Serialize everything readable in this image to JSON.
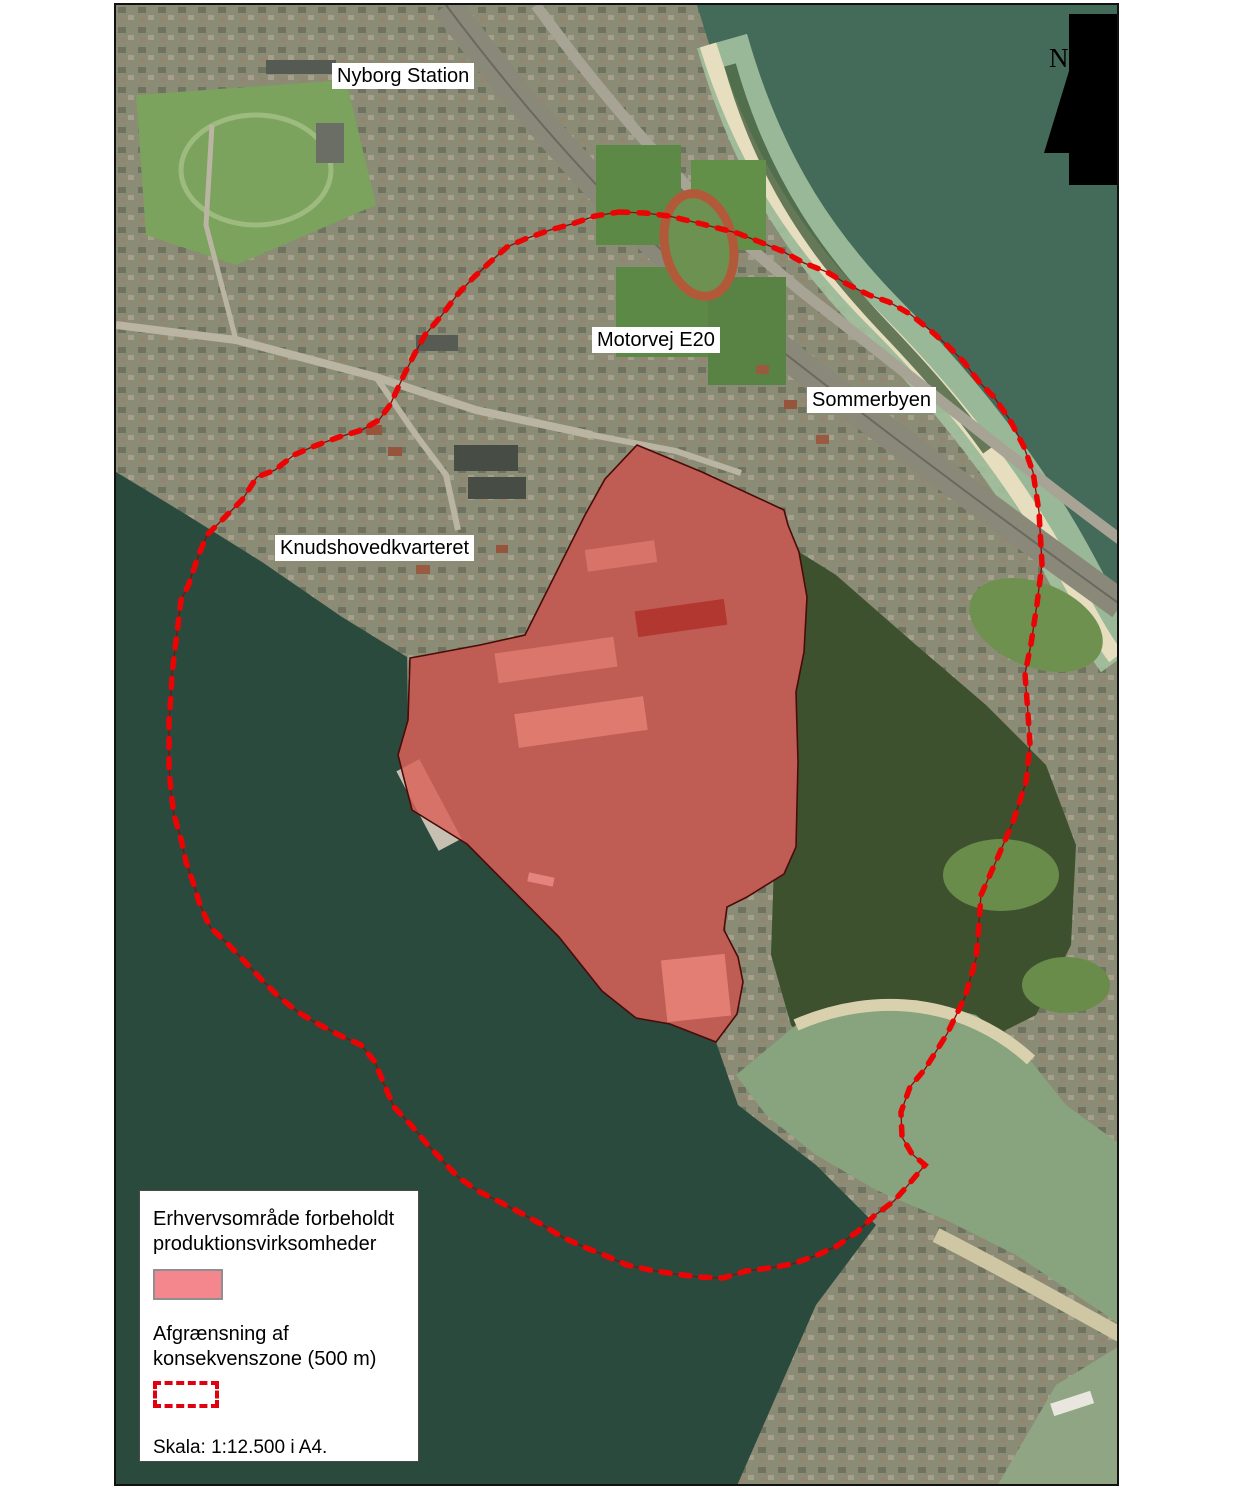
{
  "map": {
    "labels": [
      {
        "id": "nyborg-station",
        "text": "Nyborg Station"
      },
      {
        "id": "motorvej-e20",
        "text": "Motorvej E20"
      },
      {
        "id": "sommerbyen",
        "text": "Sommerbyen"
      },
      {
        "id": "knudshovedkvarteret",
        "text": "Knudshovedkvarteret"
      }
    ],
    "north_arrow": {
      "label": "N"
    },
    "production_area": {
      "fill": "#e8231d",
      "fill_opacity": 0.5,
      "stroke": "#4a0b08",
      "points": "521,440 586,467 668,505 672,520 683,547 691,592 688,647 680,687 682,757 680,842 668,869 631,892 611,902 608,925 622,952 627,977 621,1009 600,1037 554,1019 520,1013 486,986 443,932 351,839 296,805 282,750 292,715 294,653 316,649 364,640 409,630 423,602 434,580 449,550 469,510 489,474"
    },
    "consequence_zone": {
      "dash_color": "#ec0404",
      "underline_color": "#7c120c",
      "points": "503,207 529,208 553,211 586,219 621,228 644,237 666,246 688,258 711,267 731,279 753,290 773,297 794,309 814,325 833,342 848,357 863,377 878,392 894,415 908,442 917,467 923,507 926,559 921,599 915,639 909,669 912,709 914,739 910,777 897,817 881,854 865,890 862,932 860,954 849,992 831,1029 809,1064 794,1082 785,1107 786,1132 796,1149 809,1160 793,1179 778,1196 758,1211 741,1227 721,1241 699,1251 676,1259 653,1263 630,1266 607,1273 583,1272 559,1269 534,1265 511,1260 488,1250 468,1242 446,1232 425,1219 403,1207 382,1196 362,1186 342,1172 325,1154 311,1139 295,1120 278,1102 268,1079 259,1057 245,1040 223,1030 202,1019 182,1007 163,992 145,974 129,957 113,940 94,922 84,900 78,880 70,857 65,834 58,810 55,787 53,764 53,740 53,715 55,690 56,669 59,644 62,620 65,595 73,579 75,572 83,549 91,530 109,512 126,495 141,472 159,465 178,450 196,442 223,432 246,425 263,415 274,400 288,370 298,350 309,330 326,310 341,290 356,274 373,258 391,242 409,234 434,225 456,219 479,211"
    }
  },
  "legend": {
    "line1": "Erhvervsområde forbeholdt",
    "line2": "produktionsvirksomheder",
    "swatch_color": "#f4878d",
    "line3": "Afgrænsning af",
    "line4": "konsekvenszone (500 m)",
    "scale_text": "Skala: 1:12.500 i A4."
  }
}
